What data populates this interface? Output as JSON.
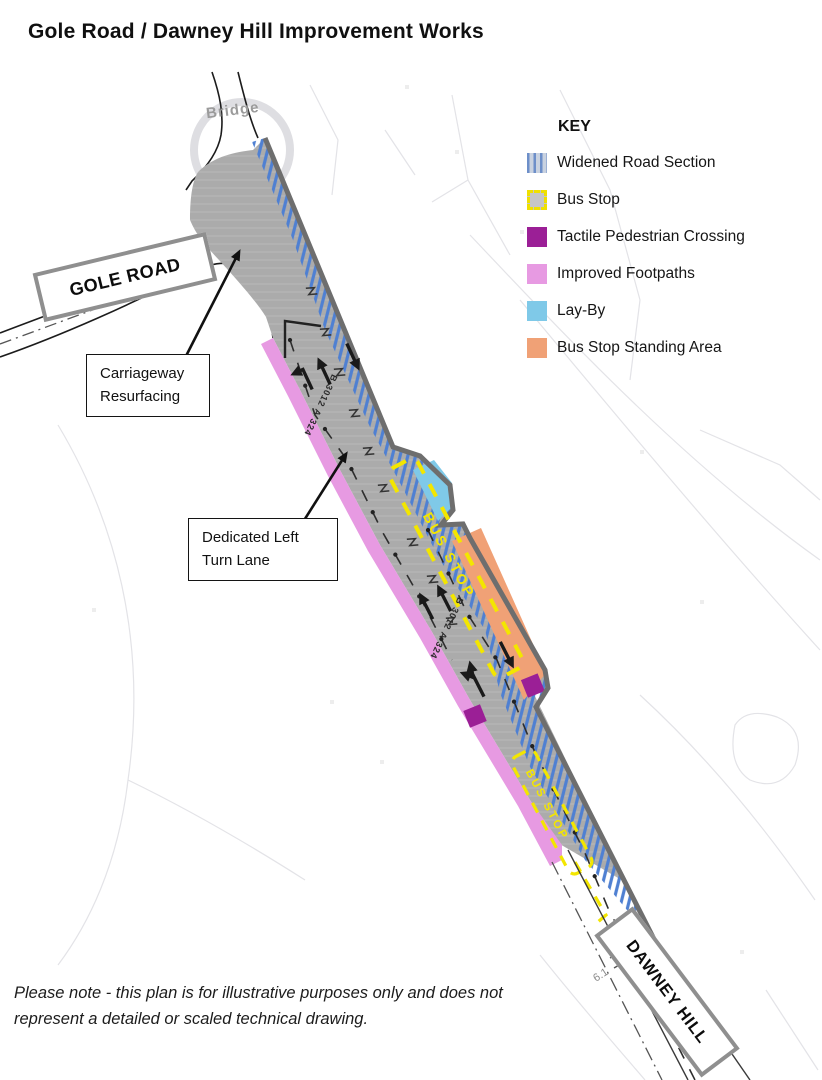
{
  "title": "Gole Road / Dawney Hill Improvement Works",
  "key": {
    "heading": "KEY",
    "items": [
      {
        "label": "Widened Road Section"
      },
      {
        "label": "Bus Stop"
      },
      {
        "label": "Tactile Pedestrian Crossing"
      },
      {
        "label": "Improved Footpaths"
      },
      {
        "label": "Lay-By"
      },
      {
        "label": "Bus Stop Standing Area"
      }
    ]
  },
  "map": {
    "bridge_label": "Bridge",
    "gole_road_label": "GOLE ROAD",
    "dawney_hill_label": "DAWNEY HILL",
    "callout_carriageway": {
      "line1": "Carriageway",
      "line2": "Resurfacing"
    },
    "callout_left_turn": {
      "line1": "Dedicated Left",
      "line2": "Turn Lane"
    },
    "bus_stop_marking": "BUS STOP",
    "road_ref_marking": "B 3012 A 324",
    "distance_marker": "6.1"
  },
  "colors": {
    "widened_road_stripe": "#4f80d2",
    "bus_stop_yellow": "#f3e600",
    "tactile_crossing": "#9b1f96",
    "improved_footpath": "#e79ae2",
    "lay_by": "#7fc9e8",
    "bus_stop_standing_area": "#f0a176",
    "carriageway": "#ababab"
  },
  "note": "Please note - this plan is for illustrative purposes only and does not represent a detailed or scaled technical drawing."
}
